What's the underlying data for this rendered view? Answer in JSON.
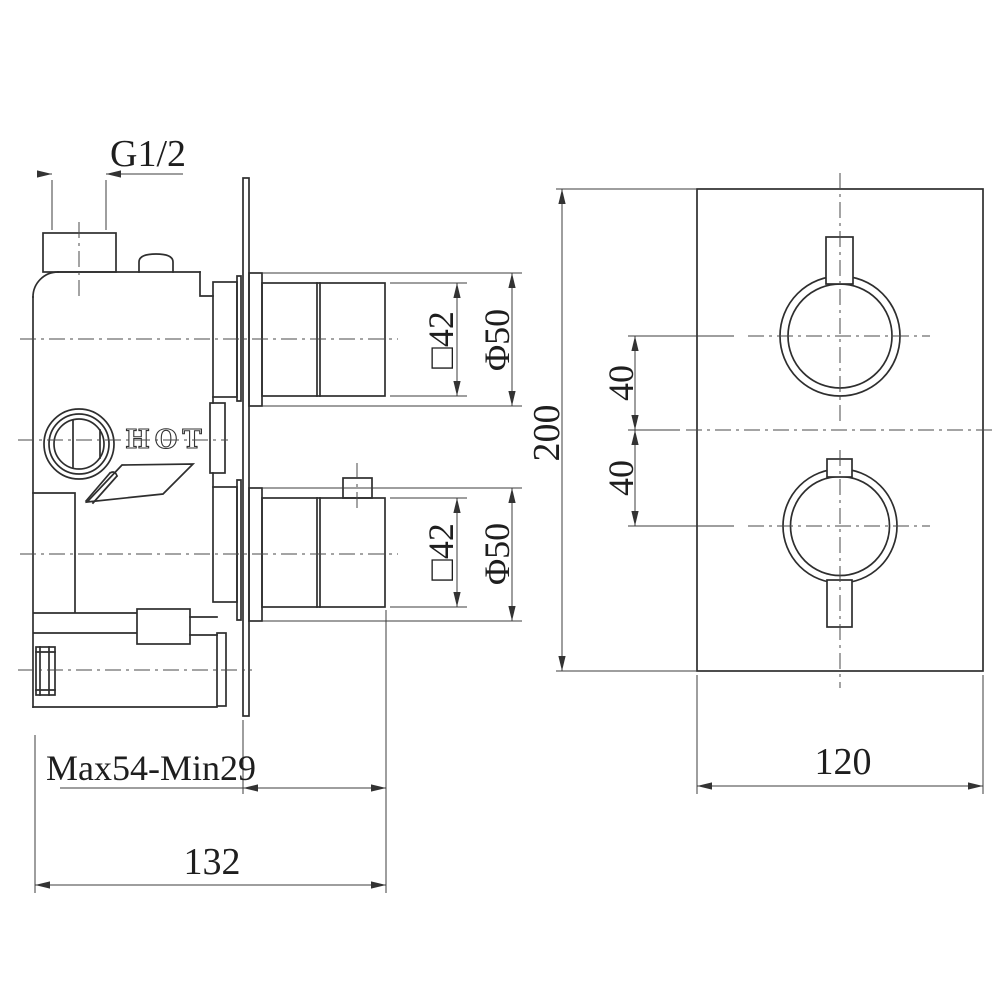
{
  "drawing": {
    "background": "#ffffff",
    "line_color": "#2e2e2e",
    "dim_color": "#3c3c3c",
    "labels": {
      "thread_size": "G1/2",
      "hot_marking": "HOT",
      "knob_square_top": "□42",
      "knob_diameter_top": "Φ50",
      "knob_square_bottom": "□42",
      "knob_diameter_bottom": "Φ50",
      "depth_range": "Max54-Min29",
      "body_depth": "132",
      "plate_height": "200",
      "knob_offset_top": "40",
      "knob_offset_bottom": "40",
      "plate_width": "120"
    }
  }
}
